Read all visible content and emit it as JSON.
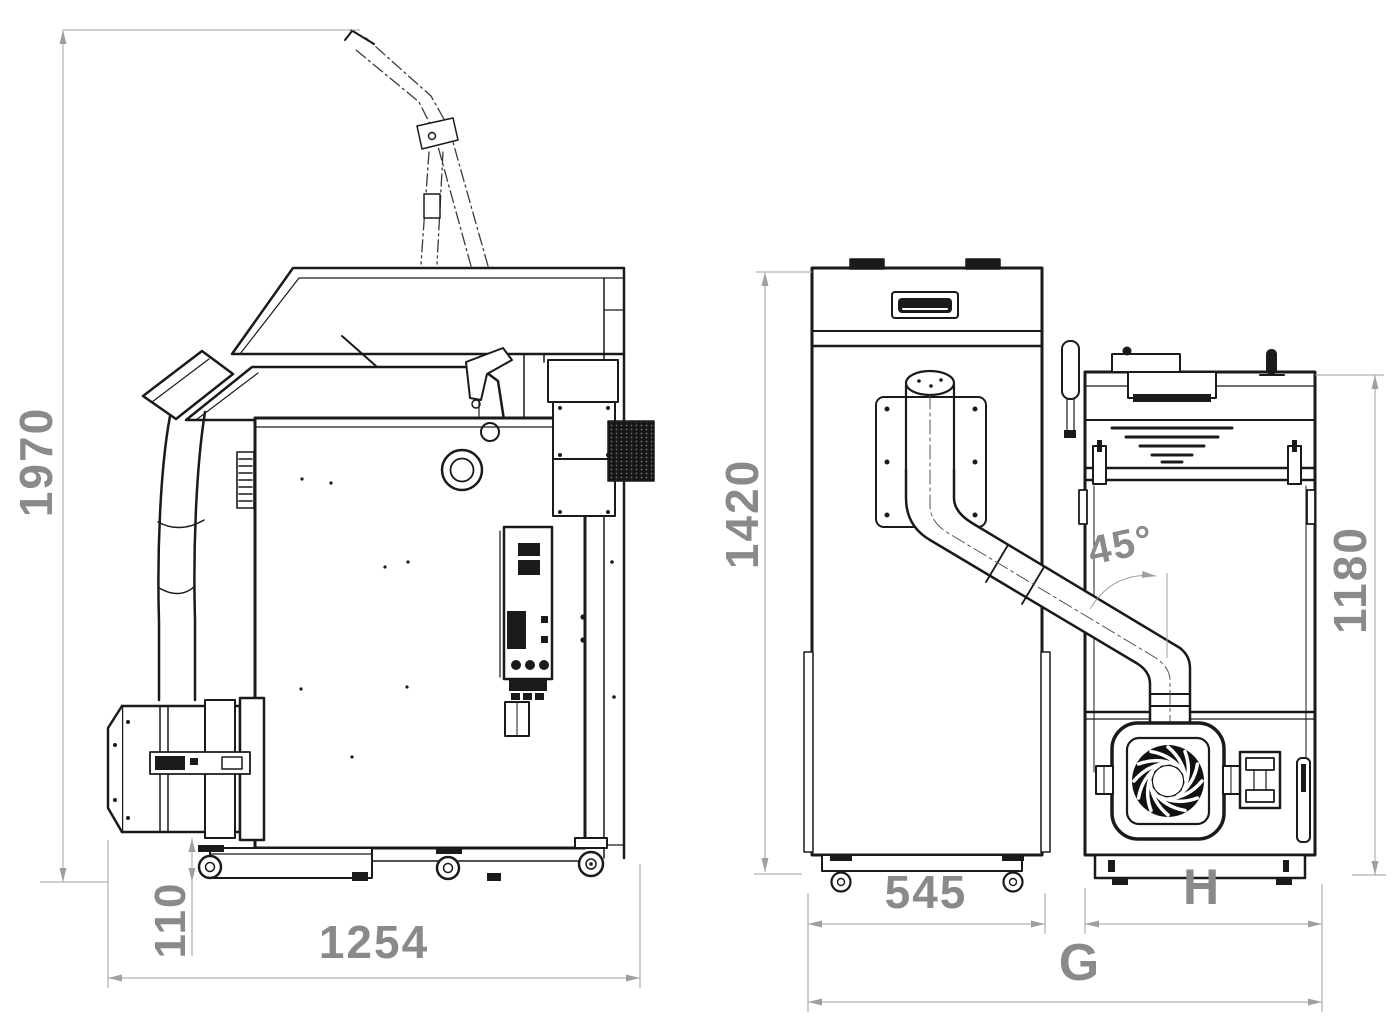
{
  "drawing": {
    "kind": "technical-dimension-drawing",
    "subject": "pellet boiler with feed hopper and burner, three orthographic views",
    "background": "#ffffff",
    "line_color": "#1a1a1a",
    "dim_line_color": "#9f9f9f",
    "dim_text_color": "#8a8a8a"
  },
  "views": [
    {
      "id": "side-view",
      "name": "boiler side view with burner, feed tube and phantom flue"
    },
    {
      "id": "hopper-front-view",
      "name": "pellet hopper front view with feed tube"
    },
    {
      "id": "boiler-front-view",
      "name": "boiler front view with combustion fan"
    }
  ],
  "dims": {
    "overall_height": "1970",
    "burner_ground_clearance": "110",
    "overall_depth": "1254",
    "hopper_height": "1420",
    "hopper_width": "545",
    "boiler_height": "1180",
    "feed_tube_angle": "45°",
    "boiler_width": "H",
    "overall_width": "G"
  }
}
